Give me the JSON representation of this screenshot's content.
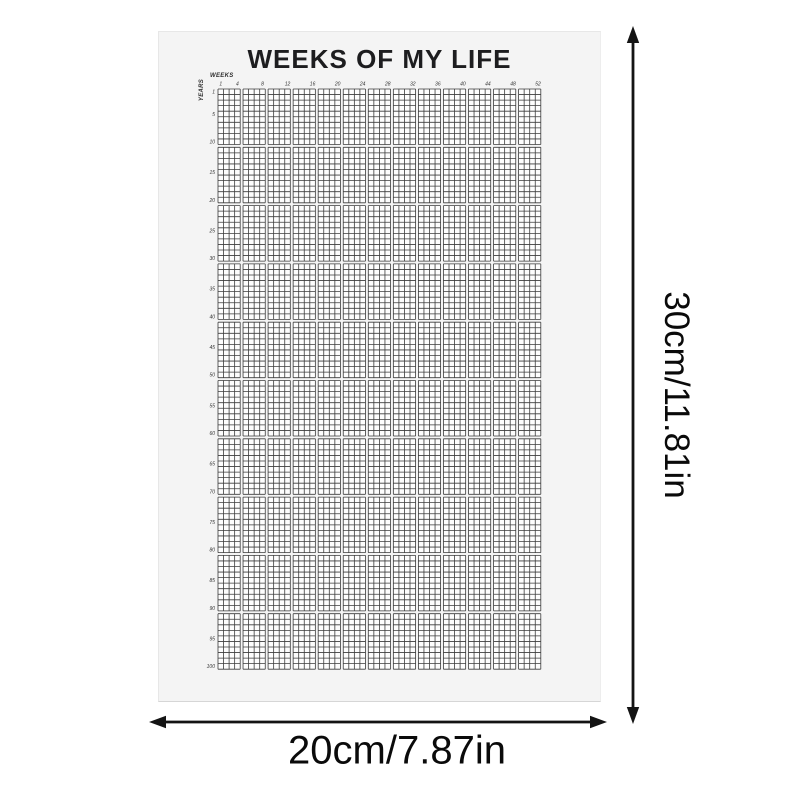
{
  "page": {
    "background": "#ffffff"
  },
  "poster": {
    "title": "WEEKS OF MY LIFE",
    "background": "#f4f4f4",
    "title_color": "#1d1d1f",
    "weeks_axis_label": "WEEKS",
    "years_axis_label": "YEARS",
    "week_tick_labels": [
      "1",
      "4",
      "8",
      "12",
      "16",
      "20",
      "24",
      "28",
      "32",
      "36",
      "40",
      "44",
      "48",
      "52"
    ],
    "year_tick_labels": [
      "1",
      "5",
      "10",
      "15",
      "20",
      "25",
      "30",
      "35",
      "40",
      "45",
      "50",
      "55",
      "60",
      "65",
      "70",
      "75",
      "80",
      "85",
      "90",
      "95",
      "100"
    ],
    "grid": {
      "weeks_per_year": 52,
      "years": 100,
      "col_group_size": 4,
      "row_group_size": 10,
      "col_groups": 13,
      "row_groups": 10,
      "cell_size": 5.55,
      "col_group_gap": 2.85,
      "row_group_gap": 2.8,
      "line_color": "#3c3c3c",
      "cell_fill": "#fdfdfd",
      "tick_color": "#333333"
    }
  },
  "dimensions": {
    "height_label": "30cm/11.81in",
    "width_label": "20cm/7.87in",
    "arrow_color": "#141414"
  }
}
